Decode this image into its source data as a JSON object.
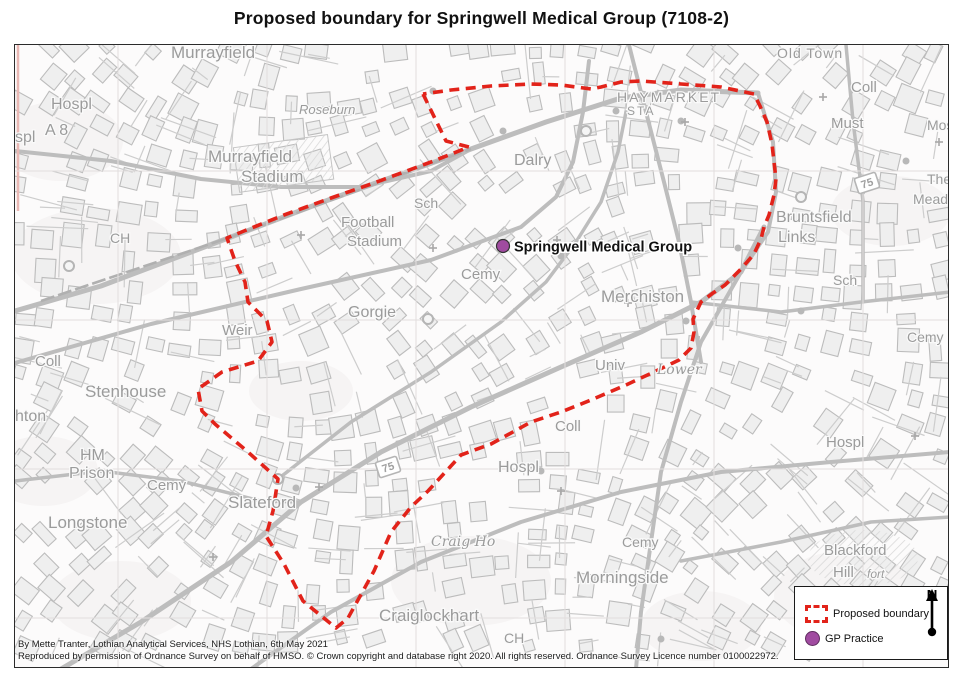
{
  "title": "Proposed boundary for Springwell Medical Group (7108-2)",
  "attribution": {
    "line1": "By Mette Tranter, Lothian Analytical Services, NHS Lothian, 6th May 2021",
    "line2": "Reproduced by permission of Ordnance Survey on behalf of HMSO. © Crown copyright and database right 2020. All rights reserved. Ordnance Survey Licence number 0100022972."
  },
  "legend": {
    "boundary_label": "Proposed boundary",
    "gp_label": "GP Practice",
    "north_label": "N"
  },
  "colors": {
    "boundary": "#e2231a",
    "gp": "#a04ba0",
    "label": "#9b9b9b",
    "road": "#bdbdbd"
  },
  "marker": {
    "label": "Springwell Medical Group",
    "x": 502,
    "y": 245
  },
  "boundary": {
    "points": [
      [
        422,
        93
      ],
      [
        445,
        140
      ],
      [
        468,
        146
      ],
      [
        430,
        161
      ],
      [
        373,
        182
      ],
      [
        330,
        197
      ],
      [
        283,
        214
      ],
      [
        243,
        230
      ],
      [
        226,
        237
      ],
      [
        234,
        260
      ],
      [
        244,
        281
      ],
      [
        247,
        301
      ],
      [
        266,
        320
      ],
      [
        271,
        341
      ],
      [
        257,
        360
      ],
      [
        221,
        371
      ],
      [
        197,
        388
      ],
      [
        201,
        410
      ],
      [
        214,
        423
      ],
      [
        247,
        451
      ],
      [
        277,
        478
      ],
      [
        272,
        510
      ],
      [
        265,
        535
      ],
      [
        283,
        563
      ],
      [
        302,
        600
      ],
      [
        335,
        627
      ],
      [
        347,
        617
      ],
      [
        373,
        570
      ],
      [
        390,
        531
      ],
      [
        410,
        506
      ],
      [
        427,
        490
      ],
      [
        460,
        454
      ],
      [
        490,
        443
      ],
      [
        530,
        421
      ],
      [
        560,
        411
      ],
      [
        590,
        399
      ],
      [
        625,
        384
      ],
      [
        655,
        370
      ],
      [
        678,
        359
      ],
      [
        690,
        347
      ],
      [
        693,
        331
      ],
      [
        692,
        318
      ],
      [
        700,
        301
      ],
      [
        712,
        292
      ],
      [
        724,
        284
      ],
      [
        740,
        268
      ],
      [
        753,
        253
      ],
      [
        760,
        238
      ],
      [
        763,
        226
      ],
      [
        768,
        214
      ],
      [
        773,
        194
      ],
      [
        775,
        178
      ],
      [
        773,
        161
      ],
      [
        771,
        143
      ],
      [
        766,
        121
      ],
      [
        759,
        105
      ],
      [
        753,
        93
      ],
      [
        720,
        86
      ],
      [
        680,
        83
      ],
      [
        640,
        80
      ],
      [
        620,
        81
      ],
      [
        600,
        86
      ],
      [
        590,
        88
      ],
      [
        560,
        84
      ],
      [
        530,
        83
      ],
      [
        490,
        85
      ],
      [
        450,
        89
      ],
      [
        422,
        93
      ]
    ]
  },
  "map": {
    "grid": {
      "vx": [
        117,
        266,
        415,
        564,
        713,
        862
      ],
      "hy": [
        170,
        319,
        468,
        617
      ]
    },
    "shields": [
      {
        "t": "75",
        "x": 866,
        "y": 182,
        "r": -18
      },
      {
        "t": "75",
        "x": 387,
        "y": 466,
        "r": -18
      }
    ],
    "labels": [
      {
        "t": "Murrayfield",
        "x": 170,
        "y": 57,
        "s": 17
      },
      {
        "t": "Hospl",
        "x": 50,
        "y": 108,
        "s": 16
      },
      {
        "t": "spl",
        "x": 14,
        "y": 141,
        "s": 16
      },
      {
        "t": "A 8",
        "x": 44,
        "y": 134,
        "s": 16
      },
      {
        "t": "Roseburn",
        "x": 298,
        "y": 113,
        "s": 13,
        "i": 1
      },
      {
        "t": "Murrayfield",
        "x": 207,
        "y": 161,
        "s": 17
      },
      {
        "t": "Stadium",
        "x": 240,
        "y": 181,
        "s": 17
      },
      {
        "t": "Football",
        "x": 340,
        "y": 226,
        "s": 15
      },
      {
        "t": "Stadium",
        "x": 346,
        "y": 245,
        "s": 15
      },
      {
        "t": "Sch",
        "x": 413,
        "y": 207,
        "s": 14
      },
      {
        "t": "Dalry",
        "x": 513,
        "y": 164,
        "s": 16
      },
      {
        "t": "HAYMARKET",
        "x": 616,
        "y": 101,
        "s": 14,
        "ls": 2
      },
      {
        "t": "STA",
        "x": 626,
        "y": 114,
        "s": 12,
        "ls": 2
      },
      {
        "t": "Old Town",
        "x": 776,
        "y": 57,
        "s": 14,
        "ls": 1
      },
      {
        "t": "Coll",
        "x": 850,
        "y": 91,
        "s": 15
      },
      {
        "t": "Must",
        "x": 830,
        "y": 127,
        "s": 15
      },
      {
        "t": "Mos",
        "x": 926,
        "y": 129,
        "s": 14
      },
      {
        "t": "The",
        "x": 926,
        "y": 183,
        "s": 14
      },
      {
        "t": "Meado",
        "x": 912,
        "y": 203,
        "s": 14
      },
      {
        "t": "Bruntsfield",
        "x": 775,
        "y": 221,
        "s": 16
      },
      {
        "t": "Links",
        "x": 777,
        "y": 241,
        "s": 16
      },
      {
        "t": "Sch",
        "x": 832,
        "y": 284,
        "s": 14
      },
      {
        "t": "Cemy",
        "x": 906,
        "y": 341,
        "s": 14
      },
      {
        "t": "Merchiston",
        "x": 600,
        "y": 301,
        "s": 17
      },
      {
        "t": "Univ",
        "x": 594,
        "y": 369,
        "s": 15
      },
      {
        "t": "Lower",
        "x": 656,
        "y": 373,
        "s": 14,
        "i": 1,
        "f": 1
      },
      {
        "t": "Coll",
        "x": 554,
        "y": 430,
        "s": 15
      },
      {
        "t": "CH",
        "x": 109,
        "y": 242,
        "s": 14
      },
      {
        "t": "Weir",
        "x": 221,
        "y": 334,
        "s": 15
      },
      {
        "t": "Coll",
        "x": 34,
        "y": 365,
        "s": 15
      },
      {
        "t": "Stenhouse",
        "x": 84,
        "y": 396,
        "s": 17
      },
      {
        "t": "hton",
        "x": 14,
        "y": 420,
        "s": 16
      },
      {
        "t": "HM",
        "x": 79,
        "y": 459,
        "s": 16
      },
      {
        "t": "Prison",
        "x": 68,
        "y": 477,
        "s": 16
      },
      {
        "t": "Cemy",
        "x": 146,
        "y": 489,
        "s": 15
      },
      {
        "t": "Longstone",
        "x": 47,
        "y": 527,
        "s": 17
      },
      {
        "t": "Slateford",
        "x": 227,
        "y": 507,
        "s": 17
      },
      {
        "t": "Craig Ho",
        "x": 430,
        "y": 545,
        "s": 14,
        "i": 1,
        "f": 1
      },
      {
        "t": "Hospl",
        "x": 497,
        "y": 471,
        "s": 16
      },
      {
        "t": "Cemy",
        "x": 621,
        "y": 546,
        "s": 14
      },
      {
        "t": "Morningside",
        "x": 575,
        "y": 582,
        "s": 17
      },
      {
        "t": "Craiglockhart",
        "x": 378,
        "y": 620,
        "s": 17
      },
      {
        "t": "CH",
        "x": 503,
        "y": 642,
        "s": 14
      },
      {
        "t": "Blackford",
        "x": 823,
        "y": 554,
        "s": 15
      },
      {
        "t": "Hill",
        "x": 832,
        "y": 576,
        "s": 15
      },
      {
        "t": "fort",
        "x": 866,
        "y": 577,
        "s": 12,
        "i": 1
      },
      {
        "t": "Hospl",
        "x": 825,
        "y": 446,
        "s": 15
      },
      {
        "t": "Gorgie",
        "x": 347,
        "y": 316,
        "s": 16
      },
      {
        "t": "Cemy",
        "x": 460,
        "y": 278,
        "s": 15
      }
    ]
  }
}
